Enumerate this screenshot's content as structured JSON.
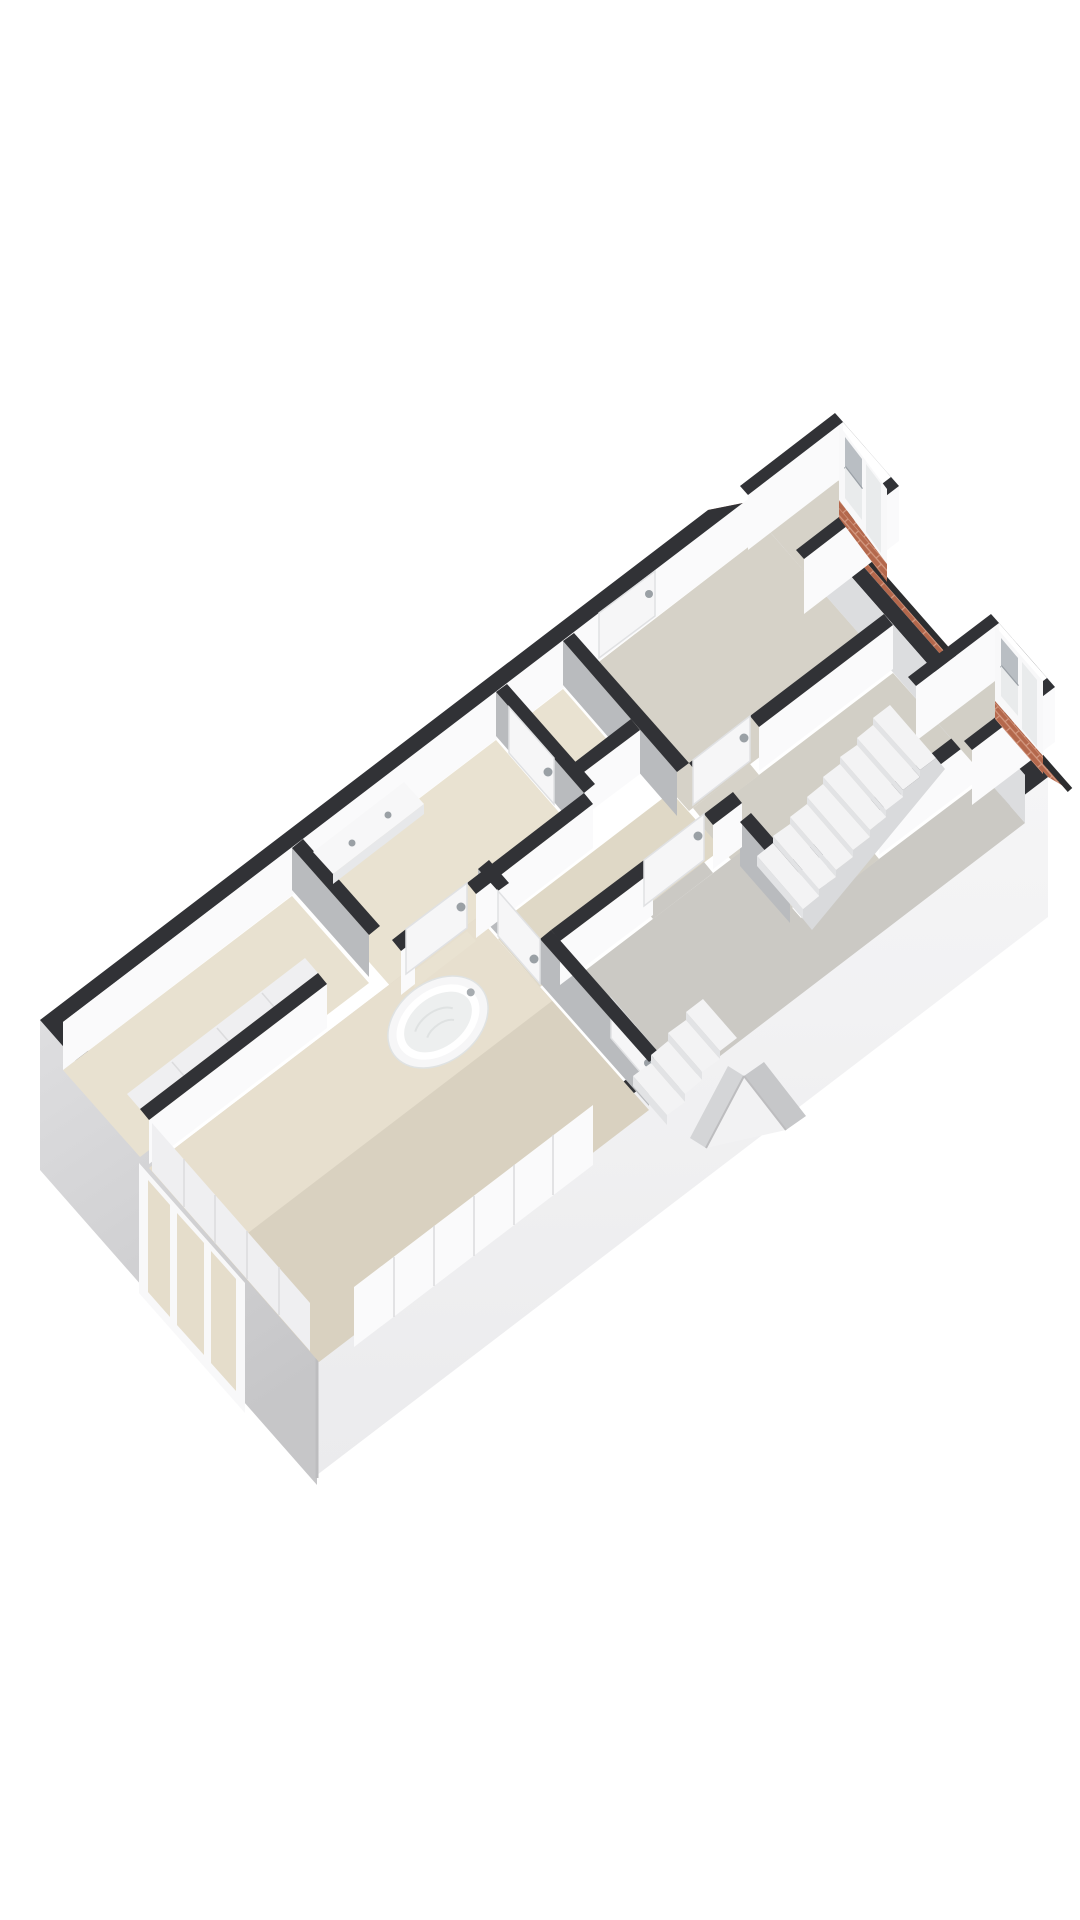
{
  "scene": {
    "type": "isometric-3d-floor-plan",
    "floor": "upper-storey",
    "rooms": [
      {
        "name": "wardrobe-niche"
      },
      {
        "name": "bathroom"
      },
      {
        "name": "wc"
      },
      {
        "name": "master-bedroom-with-bath"
      },
      {
        "name": "corridor"
      },
      {
        "name": "bedroom-2"
      },
      {
        "name": "stair-landing"
      },
      {
        "name": "bedroom-3"
      }
    ],
    "fixtures": [
      {
        "name": "freestanding-bathtub"
      },
      {
        "name": "double-washbasin"
      },
      {
        "name": "staircase-main"
      },
      {
        "name": "staircase-small"
      },
      {
        "name": "dormer-window-1"
      },
      {
        "name": "dormer-window-2"
      },
      {
        "name": "facade-window"
      },
      {
        "name": "wardrobe-panels"
      },
      {
        "name": "interior-doors-with-knobs"
      },
      {
        "name": "roof-brick-edge"
      },
      {
        "name": "gable-dormer-roof"
      }
    ]
  },
  "colors": {
    "background": "#ffffff",
    "wallBand": "#313236",
    "extFaceSW1": "#dedee0",
    "extFaceSW2": "#c6c6c8",
    "extFaceSE1": "#f5f5f6",
    "extFaceSE2": "#ebebed",
    "cornerEdge": "#bdbdbf",
    "intFaceWhite": "#fafafb",
    "intFaceWhiteDim": "#efeff1",
    "intFaceGray": "#b9bbbe",
    "intFaceGrayLight": "#dcdddf",
    "floorNiche": "#e8e1d0",
    "floorBath": "#e9e2d1",
    "floorCorridor": "#dfd8c6",
    "floorMasterLight": "#e7dfce",
    "floorMaster": "#d9d1c0",
    "floorBedroom2": "#d6d2c8",
    "floorLanding": "#d2cfc6",
    "floorBedroom3": "#cbc9c4",
    "brick": "#b4684c",
    "brickJoint": "#d49a82",
    "roofEdge": "#2c2d2f",
    "windowFrame": "#f8f8f9",
    "windowGlassWarm": "#e5ddcb",
    "glass": "#e9ebec",
    "blind": "#b9bec3",
    "blindBar": "#9aa0a6",
    "door": "#f6f6f7",
    "doorEdge": "#e0e1e3",
    "knob": "#9aa0a5",
    "stairTop": "#f3f3f4",
    "stairRiser": "#e2e3e5",
    "stairSide": "#d9dadc",
    "tub": "#f6f6f7",
    "tubRim": "#ffffff",
    "tubBasin": "#edefef",
    "tubLine": "#dfe2e2",
    "basin": "#f7f7f8",
    "basinEdge": "#e7e8ea",
    "tap": "#a7acb0",
    "panelSeam": "#dcdcde",
    "gableFace": "#f2f2f3",
    "gableRoofL": "#d4d5d7",
    "gableRoofR": "#c6c7c9"
  }
}
